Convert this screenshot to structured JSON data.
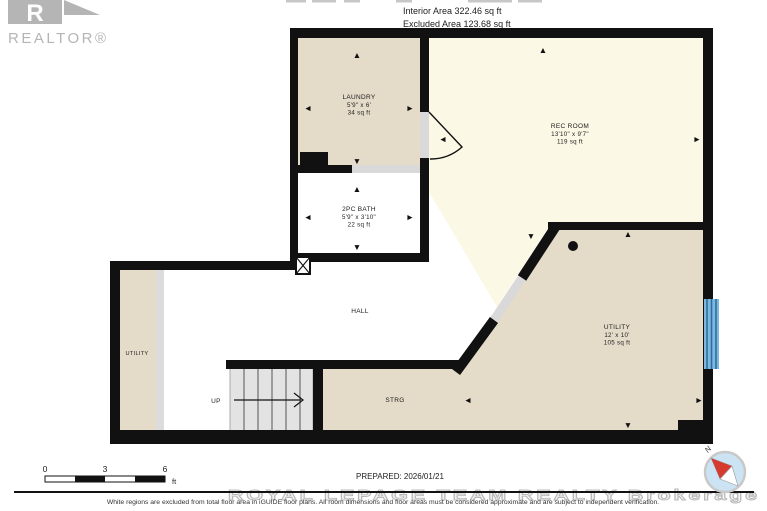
{
  "header": {
    "logo": "REALTOR®",
    "interior_area": "Interior Area 322.46 sq ft",
    "excluded_area": "Excluded Area 123.68 sq ft"
  },
  "rooms": {
    "laundry": {
      "name": "LAUNDRY",
      "dims": "5'9\" x 6'",
      "area": "34 sq ft"
    },
    "bath": {
      "name": "2PC BATH",
      "dims": "5'9\" x 3'10\"",
      "area": "22 sq ft"
    },
    "rec_room": {
      "name": "REC ROOM",
      "dims": "13'10\" x 9'7\"",
      "area": "119 sq ft"
    },
    "utility": {
      "name": "UTILITY",
      "dims": "12' x 10'",
      "area": "105 sq ft"
    },
    "utility_left": {
      "name": "UTILITY"
    },
    "hall": {
      "name": "HALL"
    },
    "storage": {
      "name": "STRG"
    },
    "stairs": {
      "label": "UP"
    }
  },
  "arrows": {
    "up": "▲",
    "down": "▼",
    "left": "◄",
    "right": "►"
  },
  "footer": {
    "scale": {
      "t0": "0",
      "t1": "3",
      "t2": "6",
      "unit": "ft"
    },
    "prepared": "PREPARED: 2026/01/21",
    "watermark": "ROYAL LEPAGE TEAM REALTY Brokerage",
    "disclaimer": "White regions are excluded from total floor area in iGUIDE floor plans. All room dimensions and floor areas must be considered approximate and are subject to independent verification.",
    "compass": {
      "north": "N"
    }
  },
  "colors": {
    "wall": "#111111",
    "room_tan": "#E5DBC9",
    "room_cream": "#FCF8E6",
    "stairs_gray": "#E3E3E3",
    "door_gray": "#D9D9D9",
    "window_blue": "#5FA8D4",
    "compass_blue": "#CBE3F2",
    "needle_red": "#D63A2F",
    "logo_gray": "#B5B5B5"
  }
}
